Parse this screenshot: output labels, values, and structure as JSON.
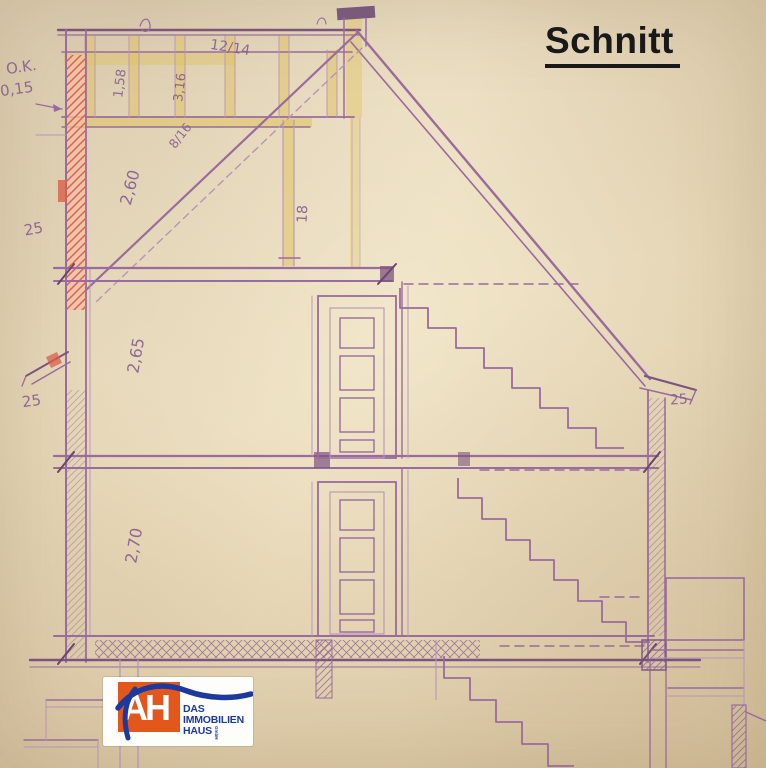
{
  "title": "Schnitt",
  "drawing": {
    "type": "architectural-cross-section",
    "annotations": {
      "ok_label": "O.K.",
      "ok_value": "0,15",
      "rafter_size": "12/14",
      "dim_a": "1,58",
      "dim_b": "3,16",
      "beam_size": "8/16",
      "attic_room_height": "2,60",
      "post_width": "18",
      "wall_upper_left": "25",
      "second_floor_height": "2,65",
      "wall_lower_left": "25",
      "wall_right": "25",
      "ground_floor_height": "2,70"
    },
    "colors": {
      "paper": "#e7d8b8",
      "pencil": "#9a6b9e",
      "pencil_dark": "#7c5480",
      "beam_yellow": "#e0c25e",
      "wall_red": "#d4543c",
      "title_ink": "#191919"
    }
  },
  "logo": {
    "monogram": "AH",
    "line1": "DAS",
    "line2": "IMMOBILIEN",
    "line3": "HAUS",
    "suffix": "GmbH",
    "orange": "#e4571c",
    "blue": "#1c3a9e"
  }
}
